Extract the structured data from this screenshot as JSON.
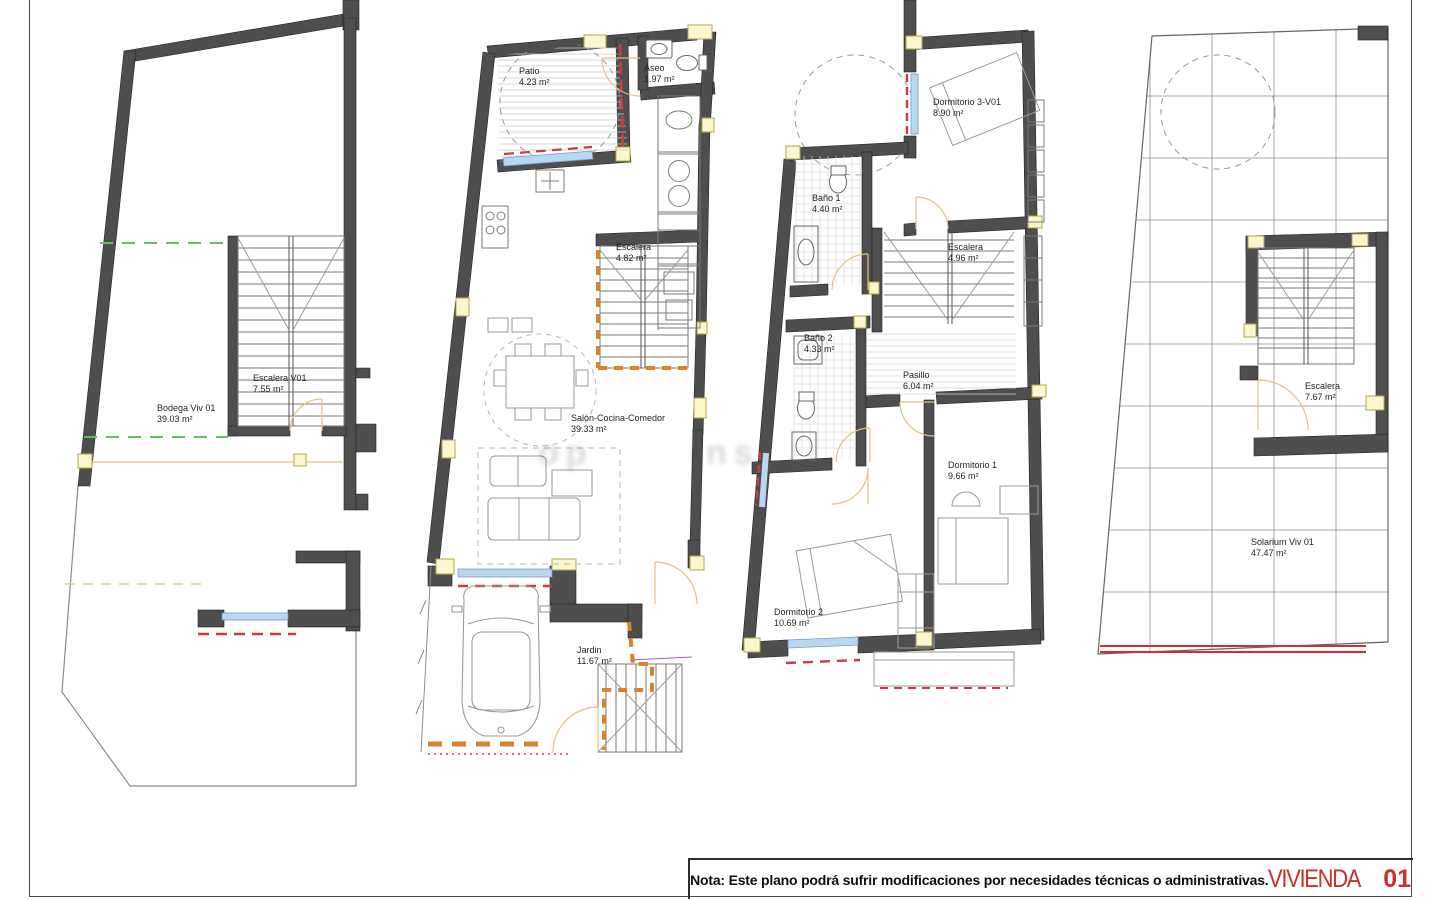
{
  "sheet": {
    "note": "Nota: Este plano podrá sufrir modificaciones por necesidades técnicas o administrativas.",
    "project_title": "VIVIENDA",
    "project_number": "01"
  },
  "watermark": {
    "fragments": [
      "op",
      "ins"
    ]
  },
  "plans": [
    {
      "id": "sotano",
      "rooms": [
        {
          "name": "Bodega Viv 01",
          "area": "39.03 m²"
        },
        {
          "name": "Escalera V01",
          "area": "7.55 m²"
        }
      ]
    },
    {
      "id": "planta-baja",
      "rooms": [
        {
          "name": "Patio",
          "area": "4.23 m²"
        },
        {
          "name": "Aseo",
          "area": "1.97 m²"
        },
        {
          "name": "Escalera",
          "area": "4.82 m²"
        },
        {
          "name": "Salón-Cocina-Comedor",
          "area": "39.33 m²"
        },
        {
          "name": "Jardin",
          "area": "11.67 m²"
        }
      ]
    },
    {
      "id": "planta-primera",
      "rooms": [
        {
          "name": "Dormitorio 3-V01",
          "area": "8.90 m²"
        },
        {
          "name": "Baño 1",
          "area": "4.40 m²"
        },
        {
          "name": "Escalera",
          "area": "4.96 m²"
        },
        {
          "name": "Baño 2",
          "area": "4.33 m²"
        },
        {
          "name": "Pasillo",
          "area": "6.04 m²"
        },
        {
          "name": "Dormitorio 1",
          "area": "9.66 m²"
        },
        {
          "name": "Dormitorio 2",
          "area": "10.69 m²"
        }
      ]
    },
    {
      "id": "cubierta",
      "rooms": [
        {
          "name": "Escalera",
          "area": "7.67 m²"
        },
        {
          "name": "Solarium Viv 01",
          "area": "47.47 m²"
        }
      ]
    }
  ]
}
